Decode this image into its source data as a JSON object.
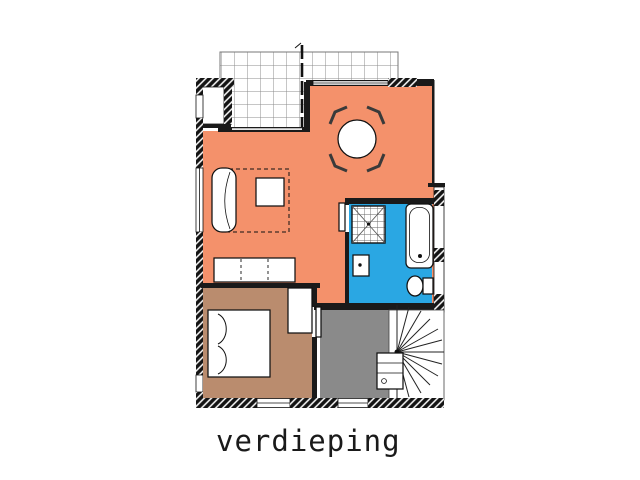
{
  "title": {
    "label": "verdieping"
  },
  "colors": {
    "living_room": "#F4916B",
    "bedroom": "#BA8C6E",
    "bathroom": "#2AA7E3",
    "hall": "#8A8A8A",
    "wall": "#1A1A1A",
    "tile_line": "#8C8C8C",
    "chair": "#3A3A3A",
    "background": "#FFFFFF"
  },
  "plan": {
    "type": "architectural-floor-plan",
    "floor_label": "verdieping",
    "rooms": [
      {
        "name": "terrace",
        "style": "tiled-grid",
        "fixtures": [
          "tile-grid",
          "expansion-joint-line"
        ]
      },
      {
        "name": "living-room",
        "color_key": "living_room",
        "fixtures": [
          "dining-table",
          "dining-chair-nw",
          "dining-chair-ne",
          "dining-chair-sw",
          "dining-chair-se",
          "sofa",
          "coffee-table",
          "dashed-rug-outline",
          "sideboard"
        ]
      },
      {
        "name": "bathroom",
        "color_key": "bathroom",
        "fixtures": [
          "shower",
          "washbasin",
          "bathtub",
          "toilet",
          "door-leaf"
        ]
      },
      {
        "name": "bedroom",
        "color_key": "bedroom",
        "fixtures": [
          "double-bed",
          "pillows",
          "wardrobe",
          "door-leaf"
        ]
      },
      {
        "name": "hall-landing",
        "color_key": "hall",
        "fixtures": []
      },
      {
        "name": "stairwell",
        "style": "white",
        "fixtures": [
          "spiral-staircase",
          "storage-closet"
        ]
      },
      {
        "name": "storage-niche",
        "style": "white",
        "fixtures": []
      }
    ],
    "wall_styles": [
      "hatched-masonry",
      "window-double-line",
      "solid-black"
    ]
  }
}
